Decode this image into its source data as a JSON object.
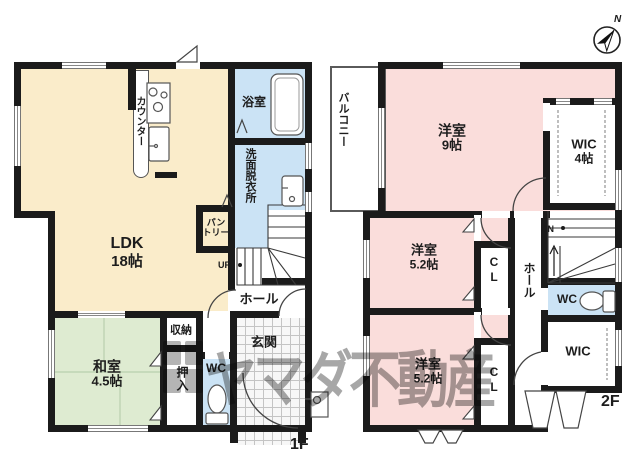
{
  "compass": {
    "north": "N"
  },
  "watermark": {
    "text": "ヤマダ不動産"
  },
  "floor1": {
    "floor_label": "1F",
    "ldk": {
      "name": "LDK",
      "size": "18帖"
    },
    "washitsu": {
      "name": "和室",
      "size": "4.5帖"
    },
    "bath": "浴室",
    "washroom": "洗面脱衣所",
    "pantry": {
      "line1": "パン",
      "line2": "トリー"
    },
    "counter": "カウンター",
    "hall": "ホール",
    "storage": "収納",
    "oshiire": "押入",
    "wc": "WC",
    "genkan": "玄関",
    "up": "UP"
  },
  "floor2": {
    "floor_label": "2F",
    "balcony": "バルコニー",
    "bedroom9": {
      "name": "洋室",
      "size": "9帖"
    },
    "wic4": {
      "name": "WIC",
      "size": "4帖"
    },
    "bedroom52a": {
      "name": "洋室",
      "size": "5.2帖"
    },
    "bedroom52b": {
      "name": "洋室",
      "size": "5.2帖"
    },
    "cl_a": "CL",
    "cl_b": "CL",
    "hall": "ホール",
    "wc": "WC",
    "wic": "WIC",
    "dn": "DN"
  },
  "colors": {
    "ldk_cream": "#faecca",
    "tatami_green": "#deebd1",
    "water_blue": "#cbe3f5",
    "bedroom_pink": "#fadddb",
    "wall_black": "#1b1b1b"
  }
}
